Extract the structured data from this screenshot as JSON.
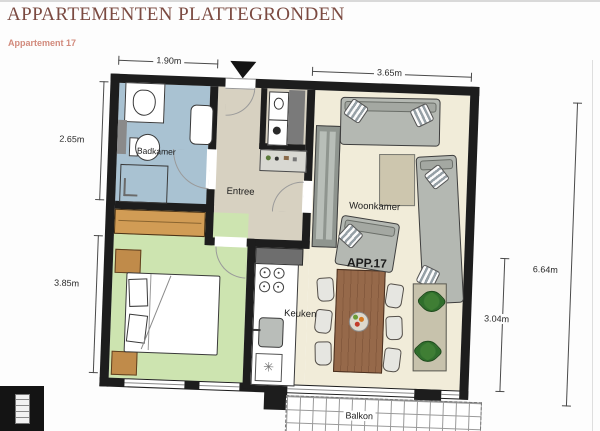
{
  "page": {
    "title": "APPARTEMENTEN PLATTEGRONDEN",
    "subtitle": "Appartement 17"
  },
  "plan": {
    "apartment_label": "APP.17",
    "rooms": {
      "badkamer": "Badkamer",
      "entree": "Entree",
      "woonkamer": "Woonkamer",
      "keuken": "Keuken",
      "balkon": "Balkon"
    },
    "dimensions": {
      "badkamer_breedte": "1.90m",
      "woonkamer_breedte": "3.65m",
      "badkamer_diepte": "2.65m",
      "slaapkamer_diepte": "3.85m",
      "totale_diepte": "6.64m",
      "woonkeuken_diepte": "3.04m"
    },
    "colors": {
      "wall": "#1d1d1d",
      "badkamer_floor": "#a9c2d2",
      "entree_floor": "#d7d1c1",
      "slaapkamer_floor": "#cde4b0",
      "woonkamer_floor": "#f1ecd9",
      "wood_furniture": "#d19c55",
      "dining_table": "#96694a",
      "sofa": "#b4b8b2",
      "title_text": "#7b4a41",
      "subtitle_text": "#d28a7c"
    }
  }
}
